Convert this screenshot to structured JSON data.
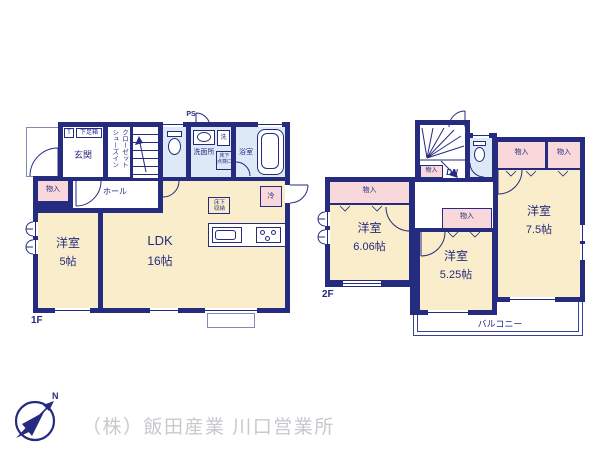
{
  "floor1": {
    "label": "1F",
    "ps": "PS",
    "entrance_label": "玄関",
    "shoe_t": "T",
    "shoe_box": "下足箱",
    "shoes_closet_l1": "シューズイン",
    "shoes_closet_l2": "クローゼット",
    "up": "UP",
    "hall": "ホール",
    "storage": "物入",
    "washroom": "洗面所",
    "washer": "洗",
    "underfloor_access_l1": "床下",
    "underfloor_access_l2": "点検口",
    "bath": "浴室",
    "fridge": "冷",
    "underfloor_storage_l1": "床下",
    "underfloor_storage_l2": "収納",
    "room_west": {
      "name": "洋室",
      "size": "5帖"
    },
    "ldk": {
      "name": "LDK",
      "size": "16帖"
    }
  },
  "floor2": {
    "label": "2F",
    "dn": "DN",
    "storage": "物入",
    "room_west1": {
      "name": "洋室",
      "size": "6.06帖"
    },
    "room_west2": {
      "name": "洋室",
      "size": "5.25帖"
    },
    "room_west3": {
      "name": "洋室",
      "size": "7.5帖"
    },
    "balcony": "バルコニー"
  },
  "footer": {
    "company": "（株）飯田産業 川口営業所",
    "compass_north": "N"
  },
  "colors": {
    "wall": "#252b7e",
    "room_fill": "#f9edcb",
    "wet_fill": "#dde9f6",
    "closet_fill": "#f8d8da",
    "company_text": "#c8c8ce"
  }
}
